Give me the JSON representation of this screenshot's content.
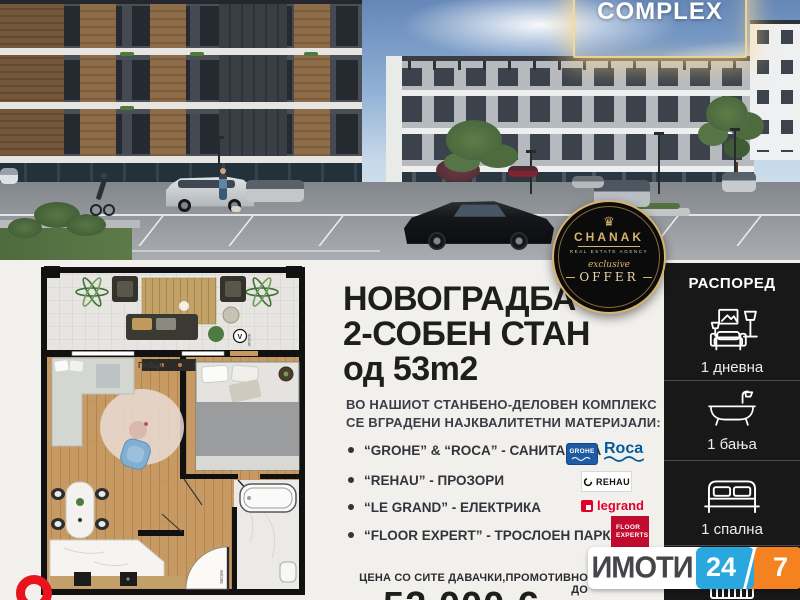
{
  "photo": {
    "badge": "COMPLEX"
  },
  "agency": {
    "name": "CHANAK",
    "crown_icon": "crown",
    "tagline": "REAL ESTATE AGENCY",
    "script": "exclusive",
    "offer": "OFFER"
  },
  "headline": {
    "line1": "НОВОГРАДБА",
    "line2": "2-СОБЕН СТАН",
    "line3": "од 53m2"
  },
  "intro": {
    "line1": "ВО НАШИОТ СТАНБЕНО-ДЕЛОВЕН КОМПЛЕКС",
    "line2": "СЕ ВГРАДЕНИ НАЈКВАЛИТЕТНИ МАТЕРИЈАЛИ:"
  },
  "materials": [
    {
      "label": "“GROHE” & “ROCA” - САНИТАРИЈА"
    },
    {
      "label": "“REHAU” - ПРОЗОРИ"
    },
    {
      "label": "“LE GRAND” - ЕЛЕКТРИКА"
    },
    {
      "label": "“FLOOR EXPERT” - ТРОСЛОЕН ПАРКЕТ"
    }
  ],
  "logos": {
    "grohe": "GROHE",
    "roca": "Roca",
    "rehau": "REHAU",
    "legrand": "legrand",
    "floor_line1": "FLOOR",
    "floor_line2": "EXPERTS"
  },
  "price": {
    "label": "ЦЕНА СО СИТЕ ДАВАЧКИ,ПРОМОТИВНО ДО",
    "value": "52.000 €"
  },
  "layout_panel": {
    "title": "РАСПОРЕД",
    "items": [
      {
        "icon": "living-room-icon",
        "label": "1 дневна"
      },
      {
        "icon": "bathtub-icon",
        "label": "1 бања"
      },
      {
        "icon": "bed-icon",
        "label": "1 спална"
      }
    ]
  },
  "floorplan": {
    "area_label": "П=0цн",
    "vent_label": "V",
    "window_dim": "90/240",
    "door_dim": "90/205"
  },
  "footer_logo": {
    "name": "ИМОТИ",
    "hours": "24",
    "days": "7"
  },
  "colors": {
    "gold": "#d9b36a",
    "panel_bg": "#181818",
    "grohe_blue": "#1f5aa5",
    "roca_blue": "#005a9c",
    "legrand_red": "#e1002a",
    "floor_experts_red": "#c00b2f",
    "imoti_blue": "#2aa7df",
    "imoti_orange": "#f58220",
    "ring_red": "#e8131c",
    "headline_black": "#1e1e1c",
    "body_text": "#3c3c46",
    "page_bg": "#f2f0ec"
  }
}
